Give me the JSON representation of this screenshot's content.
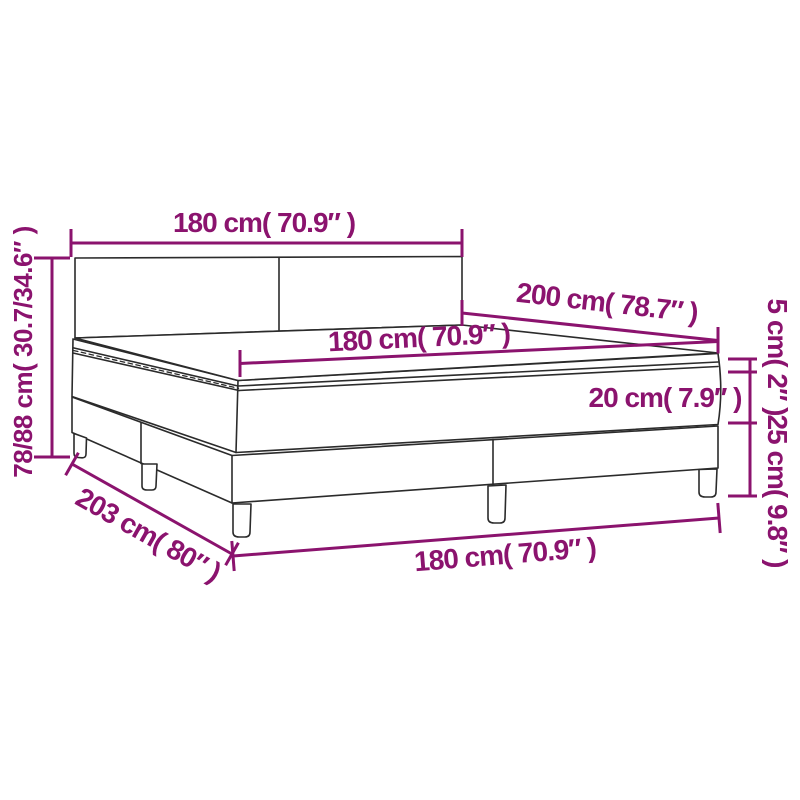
{
  "diagram": {
    "title": "box spring bed with topper mattress dimension diagram",
    "colors": {
      "dimension_accent": "#8B136E",
      "outline": "#2B2B2B",
      "background": "#FFFFFF"
    },
    "labels": {
      "top_width": "180 cm( 70.9″ )",
      "total_height": "78/88 cm( 30.7/34.6″ )",
      "length": "200 cm( 78.7″ )",
      "mattress_width": "180 cm( 70.9″ )",
      "topper_thickness": "5 cm( 2″ )",
      "mattress_thickness": "20 cm( 7.9″ )",
      "base_height": "25 cm( 9.8″ )",
      "base_length": "203 cm( 80″ )",
      "base_width": "180 cm( 70.9″ )"
    }
  }
}
